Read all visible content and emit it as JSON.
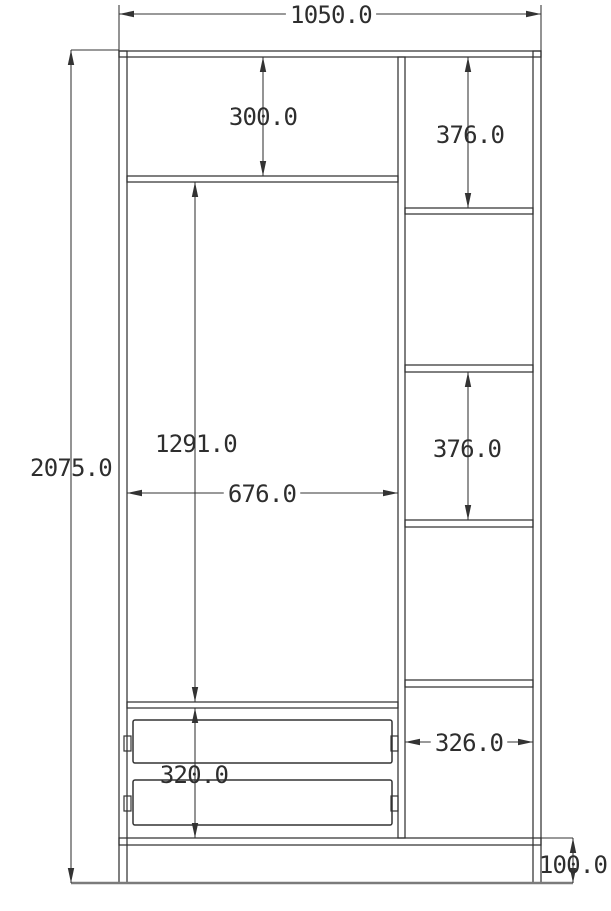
{
  "drawing": {
    "type": "technical-drawing",
    "subject": "wardrobe-front-elevation-with-dimensions",
    "units": "mm",
    "colors": {
      "background": "#ffffff",
      "line": "#333333",
      "text": "#2e2e2e",
      "ground": "#7b7b7b"
    },
    "panels": [
      {
        "name": "left-side-panel",
        "x": 119,
        "y": 51,
        "w": 8,
        "h": 832
      },
      {
        "name": "right-side-panel",
        "x": 533,
        "y": 51,
        "w": 8,
        "h": 832
      },
      {
        "name": "top-panel",
        "x": 119,
        "y": 51,
        "w": 422,
        "h": 6
      },
      {
        "name": "bottom-panel",
        "x": 119,
        "y": 838,
        "w": 422,
        "h": 7
      },
      {
        "name": "center-divider-panel",
        "x": 398,
        "y": 57,
        "w": 7,
        "h": 781
      },
      {
        "name": "left-top-shelf",
        "x": 127,
        "y": 176,
        "w": 271,
        "h": 6
      },
      {
        "name": "left-bottom-shelf",
        "x": 127,
        "y": 702,
        "w": 271,
        "h": 6
      },
      {
        "name": "right-shelf-1",
        "x": 405,
        "y": 208,
        "w": 128,
        "h": 6
      },
      {
        "name": "right-shelf-2",
        "x": 405,
        "y": 365,
        "w": 128,
        "h": 7
      },
      {
        "name": "right-shelf-3",
        "x": 405,
        "y": 520,
        "w": 128,
        "h": 7
      },
      {
        "name": "right-shelf-4",
        "x": 405,
        "y": 680,
        "w": 128,
        "h": 7
      }
    ],
    "drawers": [
      {
        "name": "drawer-1",
        "x": 133,
        "y": 720,
        "w": 259,
        "h": 43
      },
      {
        "name": "drawer-2",
        "x": 133,
        "y": 780,
        "w": 259,
        "h": 45
      }
    ],
    "drawer_slides": [
      {
        "name": "drawer-1-left-slide",
        "x": 124,
        "y": 736,
        "w": 7,
        "h": 15
      },
      {
        "name": "drawer-1-right-slide",
        "x": 391,
        "y": 736,
        "w": 7,
        "h": 15
      },
      {
        "name": "drawer-2-left-slide",
        "x": 124,
        "y": 796,
        "w": 7,
        "h": 15
      },
      {
        "name": "drawer-2-right-slide",
        "x": 391,
        "y": 796,
        "w": 7,
        "h": 15
      }
    ],
    "ground_line": {
      "name": "ground-line",
      "x1": 71,
      "x2": 573,
      "y": 883
    },
    "dimensions": [
      {
        "name": "overall-width",
        "value": "1050.0",
        "axis": "h",
        "x1": 119,
        "x2": 541,
        "y": 14,
        "label_x": 331,
        "label_y": 14,
        "mask": true,
        "extensions": [
          [
            119,
            5,
            119,
            51
          ],
          [
            541,
            5,
            541,
            51
          ]
        ]
      },
      {
        "name": "overall-height",
        "value": "2075.0",
        "axis": "v",
        "y1": 50,
        "y2": 883,
        "x": 71,
        "label_x": 71,
        "label_y": 467,
        "mask": false,
        "extensions": [
          [
            71,
            50,
            119,
            50
          ]
        ]
      },
      {
        "name": "top-compartment-height",
        "value": "300.0",
        "axis": "v",
        "y1": 57,
        "y2": 176,
        "x": 263,
        "label_x": 263,
        "label_y": 116,
        "mask": false
      },
      {
        "name": "right-compartment-1-height",
        "value": "376.0",
        "axis": "v",
        "y1": 57,
        "y2": 208,
        "x": 468,
        "label_x": 470,
        "label_y": 134,
        "mask": false
      },
      {
        "name": "main-compartment-height",
        "value": "1291.0",
        "axis": "v",
        "y1": 182,
        "y2": 702,
        "x": 195,
        "label_x": 196,
        "label_y": 443,
        "mask": false
      },
      {
        "name": "main-compartment-width",
        "value": "676.0",
        "axis": "h",
        "x1": 127,
        "x2": 398,
        "y": 493,
        "label_x": 262,
        "label_y": 493,
        "mask": true
      },
      {
        "name": "right-compartment-3-height",
        "value": "376.0",
        "axis": "v",
        "y1": 372,
        "y2": 520,
        "x": 468,
        "label_x": 467,
        "label_y": 448,
        "mask": false
      },
      {
        "name": "drawer-section-height",
        "value": "320.0",
        "axis": "v",
        "y1": 708,
        "y2": 838,
        "x": 195,
        "label_x": 194,
        "label_y": 774,
        "mask": false
      },
      {
        "name": "right-column-width",
        "value": "326.0",
        "axis": "h",
        "x1": 405,
        "x2": 533,
        "y": 742,
        "label_x": 469,
        "label_y": 742,
        "mask": true
      },
      {
        "name": "plinth-height",
        "value": "100.0",
        "axis": "v",
        "y1": 838,
        "y2": 883,
        "x": 573,
        "label_x": 573,
        "label_y": 864,
        "mask": false,
        "extensions": [
          [
            541,
            838,
            573,
            838
          ]
        ]
      }
    ]
  }
}
